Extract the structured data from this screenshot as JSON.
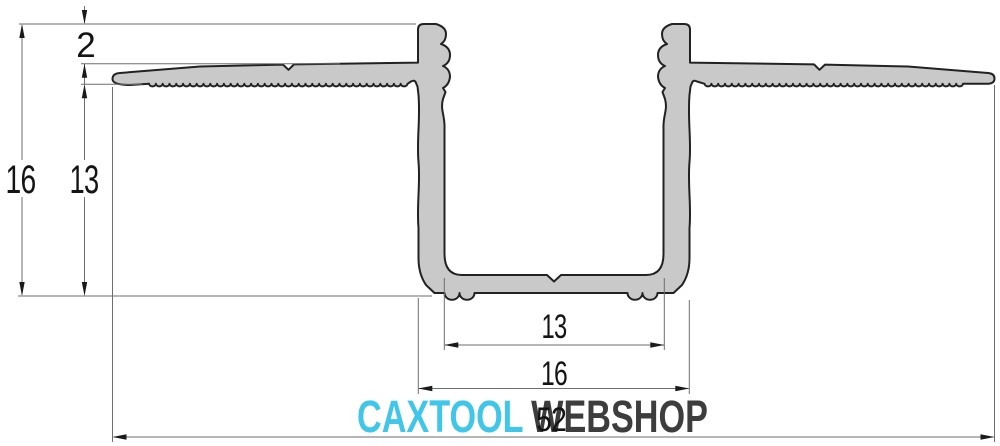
{
  "drawing": {
    "dimensions": {
      "wall_protrusion": "2",
      "height_total": "16",
      "height_below_flange": "13",
      "inner_width": "13",
      "channel_outer_width": "16",
      "total_width": "52"
    }
  },
  "watermark": {
    "brand": "CAXTOOL",
    "suffix": "WEBSHOP"
  },
  "colors": {
    "background": "#ffffff",
    "profile_fill": "#c9c9c9",
    "profile_outline": "#222222",
    "dim_line": "#6e6e6e",
    "arrow": "#1a1a1a",
    "dim_text": "#141414",
    "brand_color": "#3fc6e9",
    "suffix_color": "#3d3d3d"
  }
}
